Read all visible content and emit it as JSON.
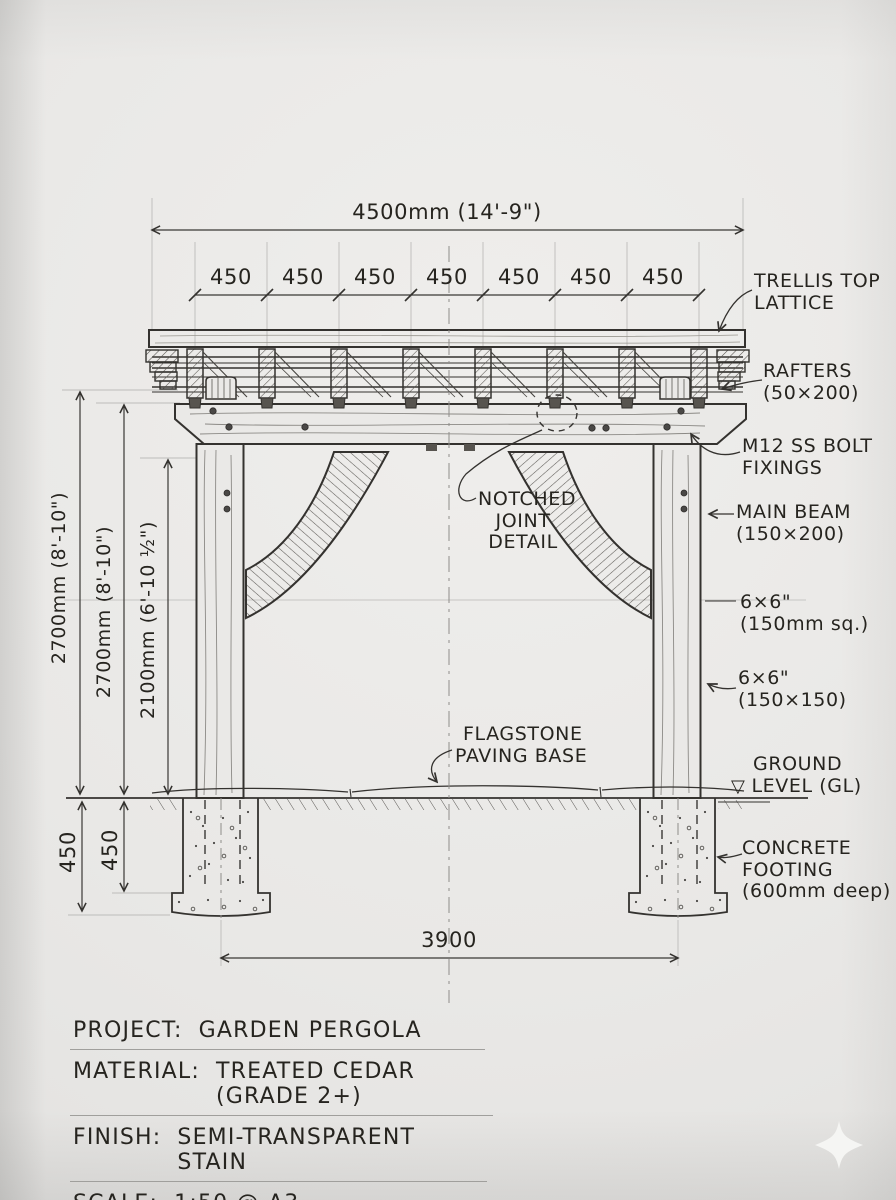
{
  "dimensions": {
    "overall_width": "4500mm (14'-9\")",
    "bays": [
      "450",
      "450",
      "450",
      "450",
      "450",
      "450",
      "450"
    ],
    "height_overall": "2700mm (8'-10\")",
    "height_beam": "2700mm (8'-10\")",
    "height_clear": "2100mm (6'-10 ½\")",
    "footing_depth_outer": "450",
    "footing_depth_inner": "450",
    "footing_span": "3900"
  },
  "callouts": {
    "trellis": [
      "TRELLIS TOP",
      "LATTICE"
    ],
    "rafters": [
      "RAFTERS",
      "(50×200)"
    ],
    "bolts": [
      "M12 SS BOLT",
      "FIXINGS"
    ],
    "main_beam": [
      "MAIN BEAM",
      "(150×200)"
    ],
    "post_imperial": [
      "6×6\"",
      "(150mm sq.)"
    ],
    "post_metric": [
      "6×6\"",
      "(150×150)"
    ],
    "ground_label": "GROUND",
    "ground_symbol": "▽",
    "ground_level": "LEVEL (GL)",
    "footing": [
      "CONCRETE",
      "FOOTING",
      "(600mm deep)"
    ],
    "notched_joint": [
      "NOTCHED",
      "JOINT",
      "DETAIL"
    ],
    "flagstone": [
      "FLAGSTONE",
      "PAVING BASE"
    ]
  },
  "title_block": {
    "rows": [
      {
        "label": "PROJECT:",
        "value": "GARDEN PERGOLA"
      },
      {
        "label": "MATERIAL:",
        "value": "TREATED CEDAR (GRADE 2+)"
      },
      {
        "label": "FINISH:",
        "value": "SEMI-TRANSPARENT STAIN"
      },
      {
        "label": "SCALE:",
        "value": "1:50 @ A3"
      }
    ]
  },
  "colors": {
    "paper": "#e9e8e6",
    "ink": "#34322f",
    "pencil": "#b5b4b2"
  }
}
